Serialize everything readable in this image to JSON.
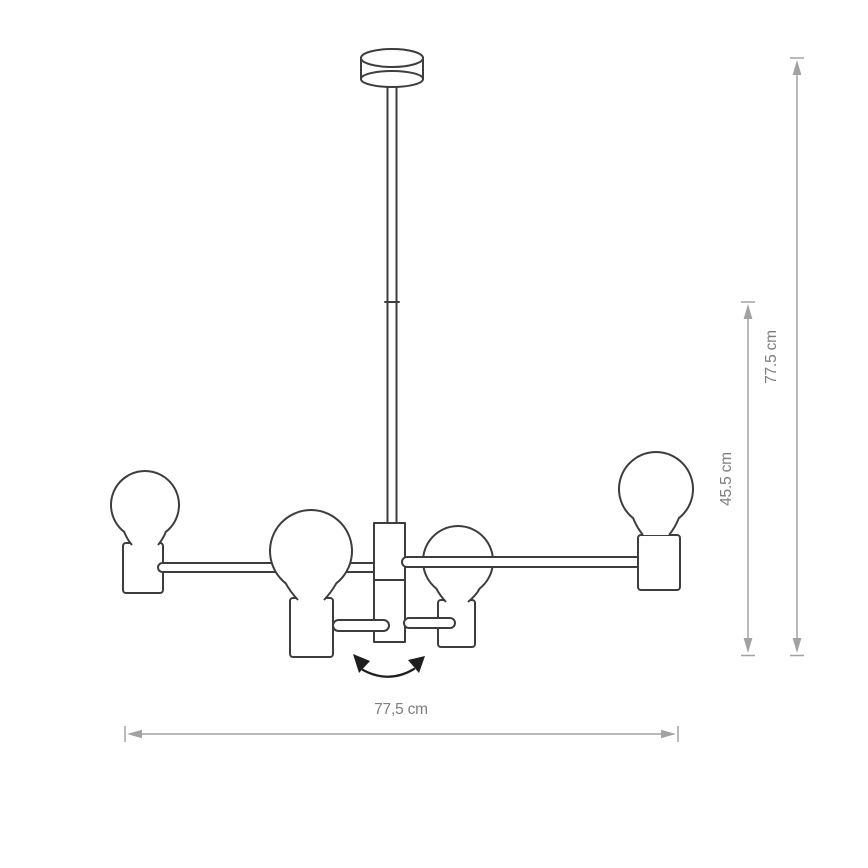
{
  "diagram": {
    "labels": {
      "width": "77,5 cm",
      "height_total": "77.5 cm",
      "height_body": "45.5 cm"
    },
    "colors": {
      "background": "#ffffff",
      "fixture_stroke": "#3d3d3d",
      "dimension_line": "#a2a2a2",
      "dimension_text": "#7e7e7e",
      "rotation_arrow": "#1e1e1e"
    }
  }
}
